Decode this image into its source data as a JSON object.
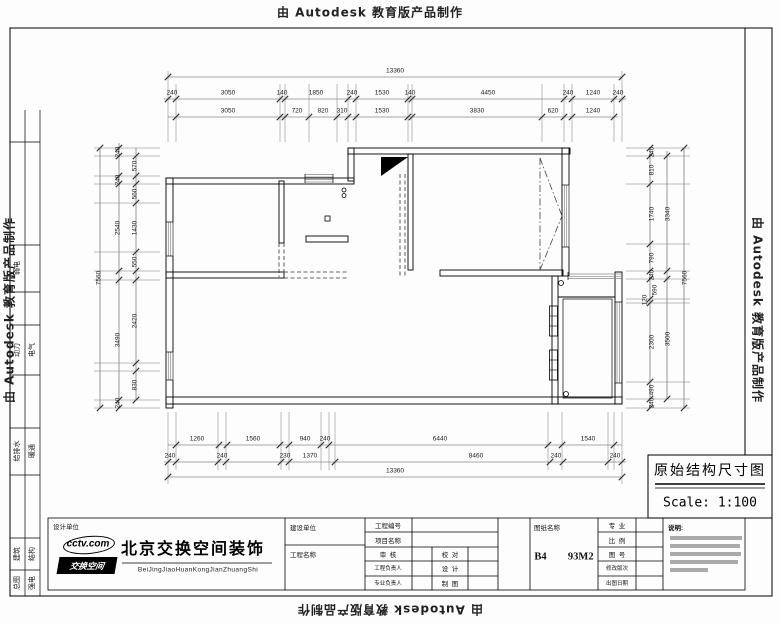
{
  "sheet": {
    "made_by_top": "由 Autodesk 教育版产品制作",
    "made_by_left": "由 Autodesk 教育版产品制作",
    "made_by_right": "由 Autodesk 教育版产品制作",
    "made_by_bottom": "由 Autodesk 教育版产品制作"
  },
  "left_strip": {
    "rows": [
      {
        "a": "弱电",
        "b": ""
      },
      {
        "a": "动力",
        "b": "电气"
      },
      {
        "a": "给排水",
        "b": "暖通"
      },
      {
        "a": "建筑",
        "b": "结构"
      },
      {
        "a": "总图",
        "b": "强电"
      }
    ]
  },
  "drawing_title": {
    "name": "原始结构尺寸图",
    "scale": "Scale: 1:100"
  },
  "title_block": {
    "design_unit_label": "设计单位",
    "logo_text": "cctv.com",
    "logo_banner": "交换空间",
    "company_name": "北京交换空间装饰",
    "company_pinyin": "BeiJingJiaoHuanKongJianZhuangShi",
    "construction_unit": "建设单位",
    "project_name": "工程名称",
    "project_no": "工程编号",
    "item_name": "项目名称",
    "review": "审  核",
    "proofread": "校  对",
    "project_lead": "工程负责人",
    "design": "设  计",
    "discipline_lead": "专业负责人",
    "draft": "制  图",
    "drawing_name_label": "图纸名称",
    "drawing_name_value": "B4  93M2",
    "discipline": "专  业",
    "scale_label": "比  例",
    "drawing_no": "图  号",
    "revision": "修改版次",
    "plot_date": "出图日期",
    "notes_label": "说明:"
  },
  "dimensions": {
    "top": [
      {
        "t": "13360",
        "x": 395,
        "y": 71
      },
      {
        "t": "240",
        "x": 172,
        "y": 93
      },
      {
        "t": "3050",
        "x": 228,
        "y": 93
      },
      {
        "t": "140",
        "x": 282,
        "y": 93
      },
      {
        "t": "1850",
        "x": 316,
        "y": 93
      },
      {
        "t": "240",
        "x": 352,
        "y": 93
      },
      {
        "t": "1530",
        "x": 382,
        "y": 93
      },
      {
        "t": "140",
        "x": 410,
        "y": 93
      },
      {
        "t": "4450",
        "x": 488,
        "y": 93
      },
      {
        "t": "240",
        "x": 568,
        "y": 93
      },
      {
        "t": "1240",
        "x": 593,
        "y": 93
      },
      {
        "t": "240",
        "x": 618,
        "y": 93
      },
      {
        "t": "3050",
        "x": 228,
        "y": 111
      },
      {
        "t": "720",
        "x": 297,
        "y": 111
      },
      {
        "t": "820",
        "x": 323,
        "y": 111
      },
      {
        "t": "310",
        "x": 342,
        "y": 111
      },
      {
        "t": "1530",
        "x": 382,
        "y": 111
      },
      {
        "t": "3830",
        "x": 477,
        "y": 111
      },
      {
        "t": "620",
        "x": 553,
        "y": 111
      },
      {
        "t": "1240",
        "x": 593,
        "y": 111
      }
    ],
    "bottom": [
      {
        "t": "1260",
        "x": 197,
        "y": 439
      },
      {
        "t": "1560",
        "x": 253,
        "y": 439
      },
      {
        "t": "940",
        "x": 305,
        "y": 439
      },
      {
        "t": "240",
        "x": 325,
        "y": 439
      },
      {
        "t": "6440",
        "x": 440,
        "y": 439
      },
      {
        "t": "1540",
        "x": 588,
        "y": 439
      },
      {
        "t": "240",
        "x": 170,
        "y": 456
      },
      {
        "t": "240",
        "x": 222,
        "y": 456
      },
      {
        "t": "230",
        "x": 285,
        "y": 456
      },
      {
        "t": "1370",
        "x": 310,
        "y": 456
      },
      {
        "t": "8460",
        "x": 476,
        "y": 456
      },
      {
        "t": "240",
        "x": 556,
        "y": 456
      },
      {
        "t": "240",
        "x": 615,
        "y": 456
      },
      {
        "t": "13360",
        "x": 395,
        "y": 471
      }
    ],
    "left": [
      {
        "t": "7560",
        "x": 99,
        "y": 278
      },
      {
        "t": "240",
        "x": 118,
        "y": 152
      },
      {
        "t": "240",
        "x": 118,
        "y": 180
      },
      {
        "t": "2540",
        "x": 118,
        "y": 228
      },
      {
        "t": "3490",
        "x": 118,
        "y": 340
      },
      {
        "t": "240",
        "x": 118,
        "y": 403
      },
      {
        "t": "570",
        "x": 135,
        "y": 166
      },
      {
        "t": "560",
        "x": 135,
        "y": 194
      },
      {
        "t": "1430",
        "x": 135,
        "y": 228
      },
      {
        "t": "550",
        "x": 135,
        "y": 262
      },
      {
        "t": "2420",
        "x": 135,
        "y": 321
      },
      {
        "t": "830",
        "x": 135,
        "y": 385
      }
    ],
    "right": [
      {
        "t": "240",
        "x": 652,
        "y": 152
      },
      {
        "t": "810",
        "x": 652,
        "y": 170
      },
      {
        "t": "1740",
        "x": 652,
        "y": 214
      },
      {
        "t": "790",
        "x": 652,
        "y": 258
      },
      {
        "t": "240",
        "x": 652,
        "y": 275
      },
      {
        "t": "590",
        "x": 655,
        "y": 290
      },
      {
        "t": "120",
        "x": 645,
        "y": 300
      },
      {
        "t": "2300",
        "x": 652,
        "y": 342
      },
      {
        "t": "490",
        "x": 652,
        "y": 390
      },
      {
        "t": "240",
        "x": 652,
        "y": 403
      },
      {
        "t": "3340",
        "x": 668,
        "y": 214
      },
      {
        "t": "3500",
        "x": 668,
        "y": 339
      },
      {
        "t": "7560",
        "x": 685,
        "y": 278
      }
    ]
  }
}
